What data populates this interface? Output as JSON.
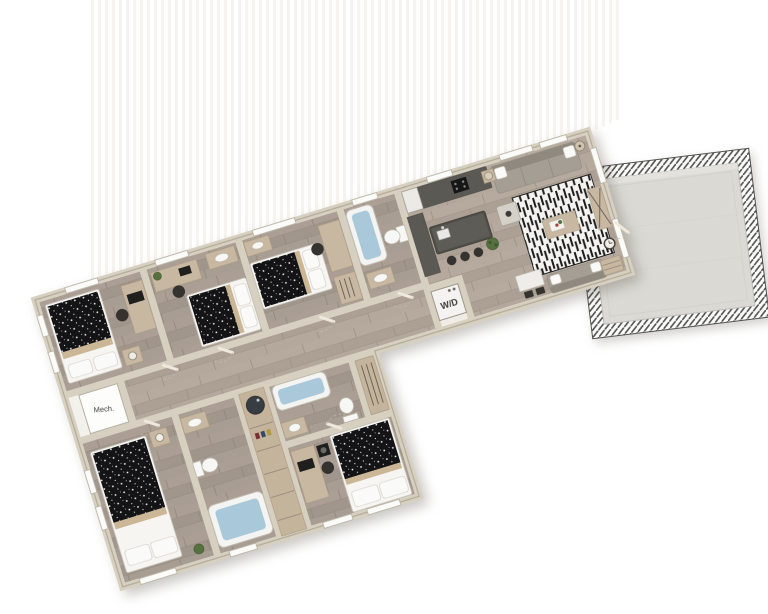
{
  "floorplan": {
    "labels": {
      "washer_dryer": "W/D",
      "mechanical": "Mech."
    },
    "colors": {
      "background": "#ffffff",
      "wall": "#d7d0c0",
      "wall_edge": "#b3aa98",
      "floor_wood": "#a79c92",
      "floor_wood_light": "#b4a89d",
      "bath_water": "#a9c9da",
      "terrace_concrete": "#dad9d4",
      "duvet_black": "#141417",
      "furniture_tan": "#c8b8a2",
      "sofa_gray": "#a49e95",
      "island_dark": "#504f4a",
      "plant_green": "#54713f"
    }
  }
}
